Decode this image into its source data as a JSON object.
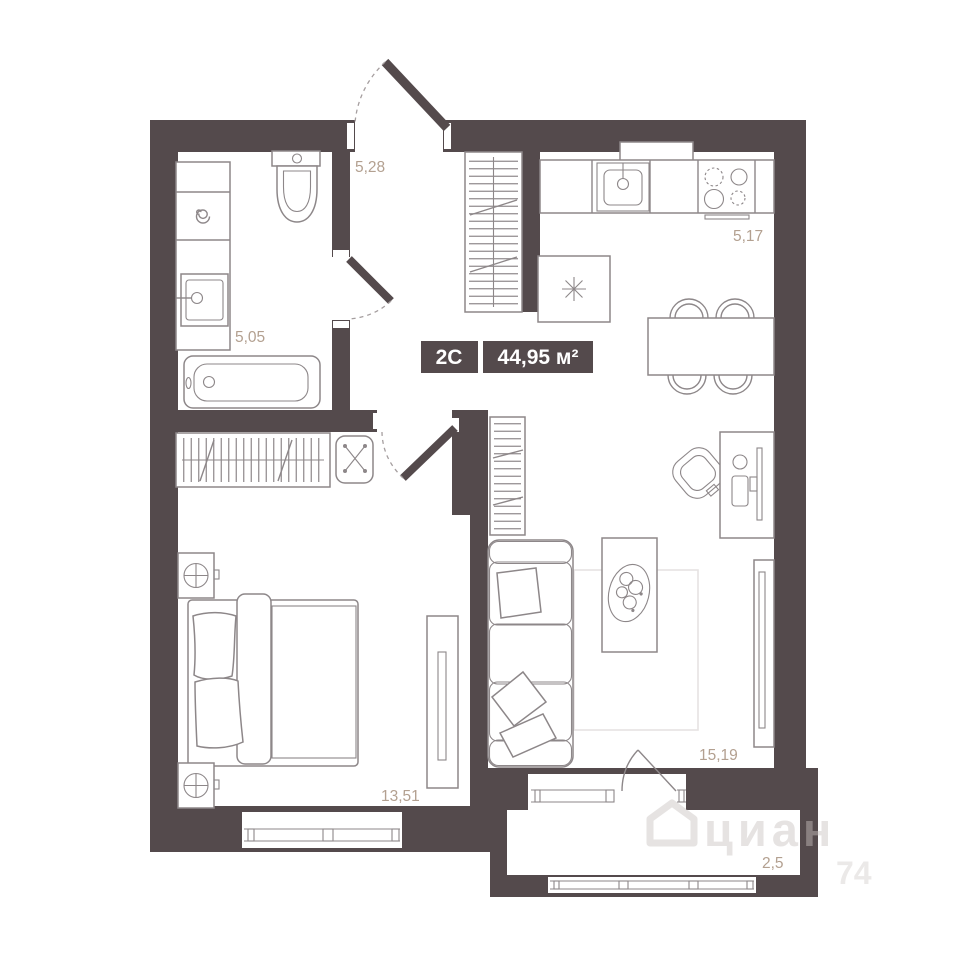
{
  "floor_plan": {
    "badge": {
      "type": "2С",
      "area": "44,95 м²"
    },
    "rooms": {
      "hallway_area": "5,28",
      "bathroom_area": "5,05",
      "kitchen_area": "5,17",
      "bedroom_area": "13,51",
      "living_room_area": "15,19",
      "balcony_area": "2,5"
    },
    "watermark": {
      "brand": "циан",
      "digits": "74"
    },
    "colors": {
      "wall": "#544a4c",
      "furniture_line": "#8d8789",
      "area_label": "#b3a090",
      "badge_text": "#ffffff",
      "background": "#ffffff"
    }
  }
}
